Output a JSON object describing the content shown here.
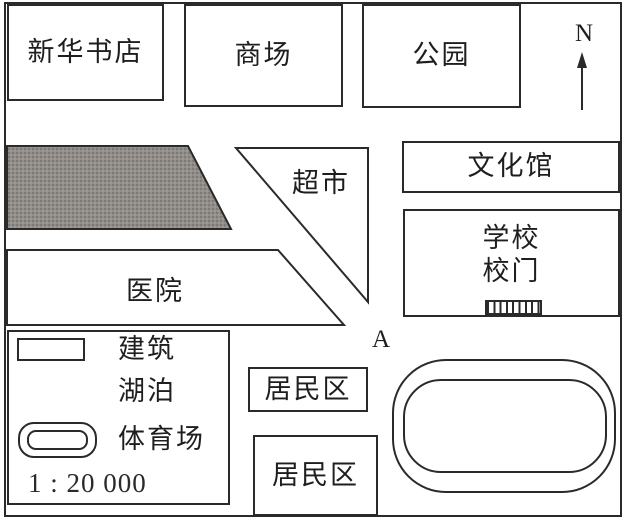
{
  "places": {
    "bookstore": "新华书店",
    "mall": "商场",
    "park": "公园",
    "supermarket": "超市",
    "cultural_center": "文化馆",
    "school": "学校",
    "school_gate": "校门",
    "hospital": "医院",
    "residential_top": "居民区",
    "residential_bottom": "居民区"
  },
  "legend": {
    "building_label": "建筑",
    "lake_label": "湖泊",
    "stadium_label": "体育场",
    "scale_text": "1 : 20 000"
  },
  "compass": {
    "north_label": "N"
  },
  "markers": {
    "point_a": "A"
  },
  "colors": {
    "line": "#2a2a2a",
    "lake_fill": "#8e8b87",
    "background": "#ffffff"
  }
}
